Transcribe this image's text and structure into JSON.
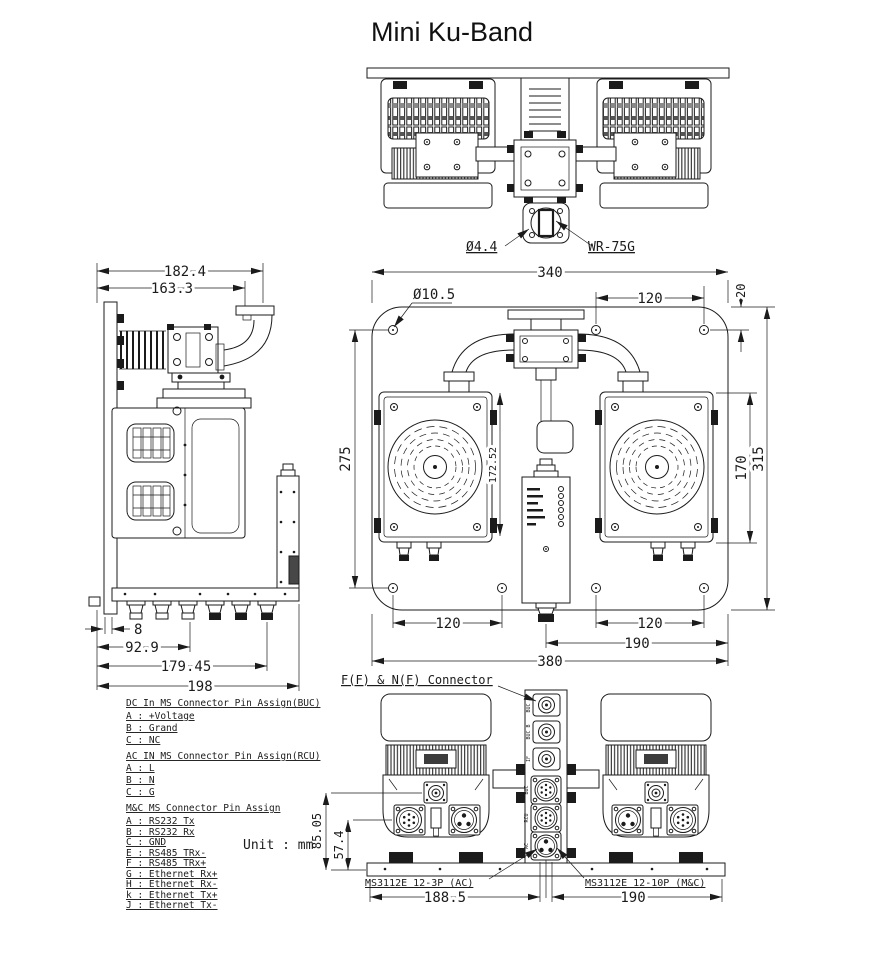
{
  "title": "Mini Ku-Band",
  "unit_note": "Unit : mm",
  "top_view": {
    "hole_dia_label": "Ø4.4",
    "waveguide_label": "WR-75G"
  },
  "side_view": {
    "dim_width_outer": "182.4",
    "dim_width_inner": "163.3",
    "dim_offset": "8",
    "dim_conn1": "92.9",
    "dim_conn2": "179.45",
    "dim_total_width": "198"
  },
  "front_view": {
    "dim_mount_width": "340",
    "dim_hole_dia": "Ø10.5",
    "dim_hole_pitch_top": "120",
    "dim_edge_offset": "20",
    "dim_left_height": "275",
    "dim_center_height": "172.52",
    "dim_buc_height": "170",
    "dim_total_height": "315",
    "dim_hole_pitch_bottom_left": "120",
    "dim_hole_pitch_bottom_right": "120",
    "dim_mc_offset": "190",
    "dim_total_width": "380"
  },
  "bottom_view": {
    "connector_note": "F(F) & N(F) Connector",
    "ac_connector_label": "MS3112E 12-3P (AC)",
    "mc_connector_label": "MS3112E 12-10P (M&C)",
    "dim_left_width": "188.5",
    "dim_right_width": "190",
    "dim_conn_height": "85.05",
    "dim_ms_height": "57.4",
    "port_labels": [
      "BUC A",
      "BUC B",
      "IF",
      "BUC",
      "RCU",
      "AC"
    ]
  },
  "notes": {
    "dc": {
      "heading": "DC In MS Connector Pin Assign(BUC)",
      "items": [
        "A : +Voltage",
        "B : Grand",
        "C : NC"
      ]
    },
    "ac": {
      "heading": "AC IN MS Connector Pin Assign(RCU)",
      "items": [
        "A : L",
        "B : N",
        "C : G"
      ]
    },
    "mc": {
      "heading": "M&C MS Connector Pin Assign",
      "items": [
        "A : RS232 Tx",
        "B : RS232 Rx",
        "C : GND",
        "E : RS485 TRx-",
        "F : RS485 TRx+",
        "G : Ethernet Rx+",
        "H : Ethernet Rx-",
        "k : Ethernet Tx+",
        "J : Ethernet Tx-"
      ]
    }
  },
  "colors": {
    "line": "#1b1b1b",
    "background": "#ffffff"
  }
}
